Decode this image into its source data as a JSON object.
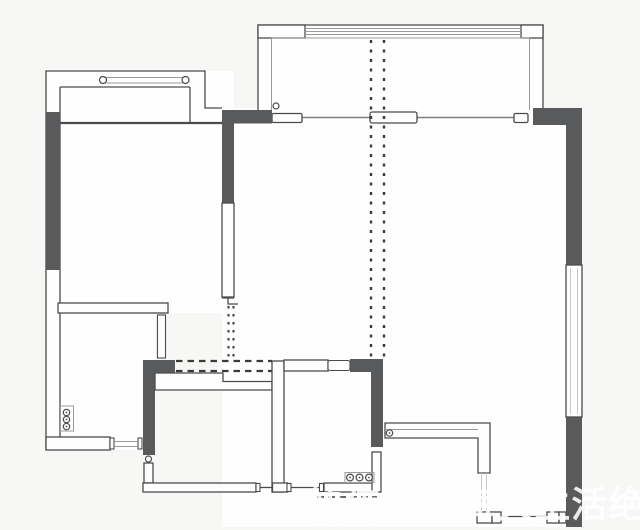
{
  "watermark": {
    "text": "快传号 / 每天生活绝招"
  },
  "colors": {
    "background": "#f7f7f5",
    "room_fill": "#fefefe",
    "wall_dark": "#595a5c",
    "wall_line": "#4b4b4d",
    "thin_line": "#9a9a9a",
    "faint_line": "#c9c9c9",
    "dash_line": "#3a3a3a",
    "watermark_color": "rgba(255,255,255,0.88)"
  },
  "symbols": {
    "bay_window": "double line with circle end caps",
    "window": "parallel thin lines between end caps",
    "sliding_door": "offset white panels on a track line",
    "door_leaf": "thin open rectangle perpendicular to wall",
    "door_hinge": "small circle",
    "beam_dashed": "dashed double line (structure above)",
    "pipe_stack": "three stacked circles in a box",
    "stove_fixture": "three circles in a row"
  }
}
